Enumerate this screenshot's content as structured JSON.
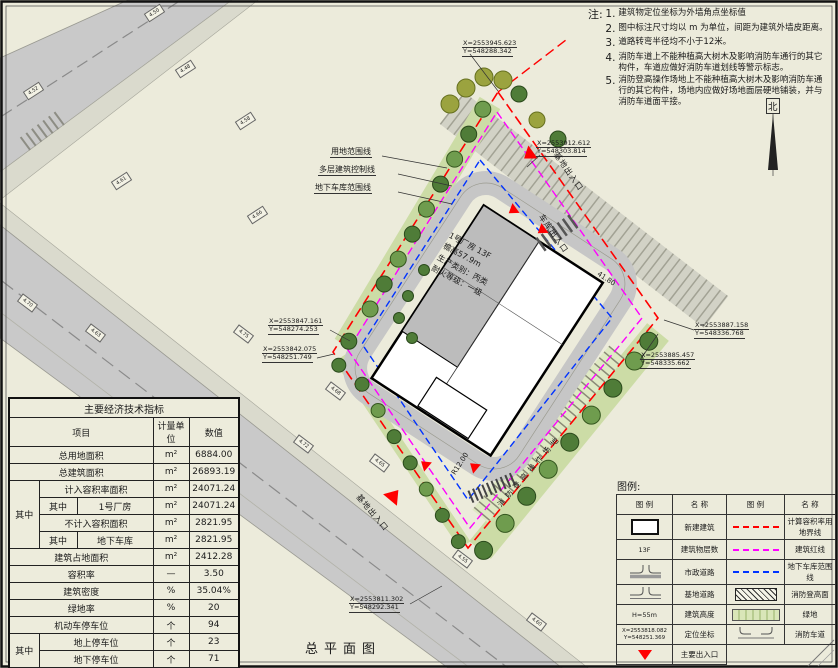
{
  "drawing": {
    "title": "总平面图",
    "north_label": "北"
  },
  "notes": {
    "heading": "注:",
    "items": [
      "建筑物定位坐标为外墙角点坐标值",
      "图中标注尺寸均以 m 为单位，间距为建筑外墙皮距离。",
      "道路转弯半径均不小于12米。",
      "消防车道上不能种植高大树木及影响消防车通行的其它构件，车道应做好消防车道划线等警示标志。",
      "消防登高操作场地上不能种植高大树木及影响消防车通行的其它构件，场地内应做好场地面层硬地铺装，并与消防车道面平接。"
    ]
  },
  "coordinates": {
    "top": {
      "x": "X=2553945.623",
      "y": "Y=548288.342"
    },
    "top_right": {
      "x": "X=2553912.612",
      "y": "Y=548303.814"
    },
    "left_upper": {
      "x": "X=2553847.161",
      "y": "Y=548274.253"
    },
    "left_lower": {
      "x": "X=2553842.075",
      "y": "Y=548251.749"
    },
    "right_upper": {
      "x": "X=2553887.158",
      "y": "Y=548336.768"
    },
    "right_lower": {
      "x": "X=2553885.457",
      "y": "Y=548335.662"
    },
    "bottom": {
      "x": "X=2553811.302",
      "y": "Y=548292.341"
    }
  },
  "plan_labels": {
    "site_boundary": "用地范围线",
    "building_control": "多层建筑控制线",
    "garage_boundary": "地下车库范围线",
    "garage_entrance": "车库出入口",
    "site_entrance_top": "基地出入口",
    "site_entrance_bottom": "基地出入口",
    "fire_operation_field": "消防登高操作场地",
    "turn_radius": "R12.00",
    "dim_length": "41.80"
  },
  "building": {
    "line1": "1号厂房 13F",
    "line2": "檐高57.9m",
    "line3": "生产类别：丙类",
    "line4": "耐火等级：一级"
  },
  "table": {
    "title": "主要经济技术指标",
    "col_item": "项目",
    "col_unit": "计量单位",
    "col_value": "数值",
    "sub": "其中",
    "rows": {
      "total_land": {
        "label": "总用地面积",
        "unit": "m²",
        "value": "6884.00"
      },
      "total_floor": {
        "label": "总建筑面积",
        "unit": "m²",
        "value": "26893.19"
      },
      "counted_far": {
        "label": "计入容积率面积",
        "unit": "m²",
        "value": "24071.24"
      },
      "workshop": {
        "label": "1号厂房",
        "unit": "m²",
        "value": "24071.24"
      },
      "uncounted_far": {
        "label": "不计入容积面积",
        "unit": "m²",
        "value": "2821.95"
      },
      "basement": {
        "label": "地下车库",
        "unit": "m²",
        "value": "2821.95"
      },
      "footprint": {
        "label": "建筑占地面积",
        "unit": "m²",
        "value": "2412.28"
      },
      "far": {
        "label": "容积率",
        "unit": "—",
        "value": "3.50"
      },
      "density": {
        "label": "建筑密度",
        "unit": "%",
        "value": "35.04%"
      },
      "green_rate": {
        "label": "绿地率",
        "unit": "%",
        "value": "20"
      },
      "motor_parking": {
        "label": "机动车停车位",
        "unit": "个",
        "value": "94"
      },
      "ground_parking": {
        "label": "地上停车位",
        "unit": "个",
        "value": "23"
      },
      "underground_parking": {
        "label": "地下停车位",
        "unit": "个",
        "value": "71"
      },
      "non_motor_parking": {
        "label": "非机动车停车位",
        "unit": "个",
        "value": "147"
      }
    }
  },
  "legend": {
    "heading": "图例:",
    "col_symbol": "图 例",
    "col_name": "名 称",
    "left": [
      {
        "name": "新建建筑"
      },
      {
        "name": "建筑物层数",
        "symbol_text": "13F"
      },
      {
        "name": "市政道路"
      },
      {
        "name": "基地道路"
      },
      {
        "name": "建筑高度",
        "symbol_text": "H=55m"
      },
      {
        "name": "定位坐标",
        "symbol_text_x": "X=2553818.082",
        "symbol_text_y": "Y=548251.369"
      },
      {
        "name": "主要出入口"
      }
    ],
    "right": [
      {
        "name": "计算容积率用地界线"
      },
      {
        "name": "建筑红线"
      },
      {
        "name": "地下车库范围线"
      },
      {
        "name": "消防登高面"
      },
      {
        "name": "绿地"
      },
      {
        "name": "消防车道"
      }
    ]
  },
  "spot_elevations": [
    "4.50",
    "4.52",
    "4.48",
    "4.61",
    "4.58",
    "4.66",
    "4.70",
    "4.63",
    "4.75",
    "4.68",
    "4.72",
    "4.55",
    "4.60",
    "4.65"
  ],
  "colors": {
    "boundary_red": "#ff0000",
    "building_magenta": "#ff00ff",
    "garage_blue": "#0033ff",
    "road_gray": "#c9c9c9",
    "green_strip": "#ccdca6",
    "paper": "#ecebdb"
  }
}
